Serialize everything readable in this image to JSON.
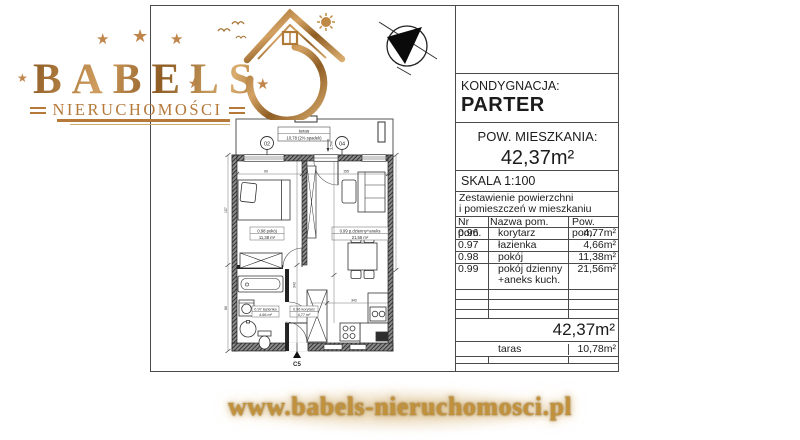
{
  "logo": {
    "brand": "BABELS",
    "subtitle": "NIERUCHOMOŚCI",
    "accent_color": "#b5793a",
    "star_icon": "★"
  },
  "title_block": {
    "floor_label": "KONDYGNACJA:",
    "floor_value": "PARTER",
    "area_label": "POW. MIESZKANIA:",
    "area_value": "42,37m²",
    "scale_label": "SKALA  1:100",
    "table": {
      "title_line1": "Zestawienie powierzchni",
      "title_line2": "i pomieszczeń w mieszkaniu",
      "col_nr": "Nr pom.",
      "col_name": "Nazwa pom.",
      "col_area": "Pow. pom.",
      "rows": [
        {
          "nr": "0.96",
          "name": "korytarz",
          "area": "4,77m²"
        },
        {
          "nr": "0.97",
          "name": "łazienka",
          "area": "4,66m²"
        },
        {
          "nr": "0.98",
          "name": "pokój",
          "area": "11,38m²"
        },
        {
          "nr": "0.99",
          "name": "pokój dzienny",
          "name_line2": "+aneks kuch.",
          "area": "21,56m²"
        }
      ],
      "total_area": "42,37m²",
      "taras_name": "taras",
      "taras_area": "10,78m²"
    }
  },
  "floor_plan": {
    "taras_label": "taras",
    "taras_area": "10,78 (2% spadek)",
    "marker_left": "02",
    "marker_right": "04",
    "slope_label": "1,5%",
    "entrance_label": "C5",
    "labels": {
      "bedroom_l1": "0.98 pokój",
      "bedroom_l2": "11,38 m²",
      "living_l1": "0.99 p.dzienny+aneks",
      "living_l2": "21,56 m²",
      "bath_l1": "0.97 łazienka",
      "bath_l2": "4,66 m²",
      "corridor_l1": "0.96 korytarz",
      "corridor_l2": "4,77 m²"
    },
    "dims": {
      "d1": "99",
      "d2": "157",
      "d3": "86",
      "d4": "343",
      "d5": "342",
      "d6": "155"
    }
  },
  "footer": {
    "url": "www.babels-nieruchomosci.pl"
  }
}
